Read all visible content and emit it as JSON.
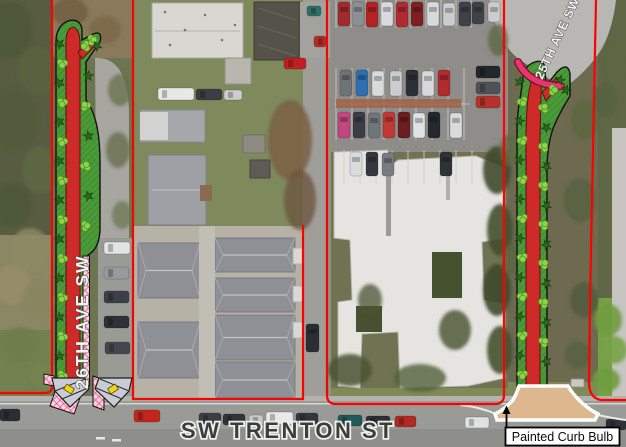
{
  "map": {
    "type": "aerial-improvement-plan",
    "street_labels": {
      "left_avenue": "26TH AVE SW",
      "right_avenue": "25TH AVE SW",
      "bottom_street": "SW TRENTON ST"
    },
    "callout": {
      "label": "Painted Curb Bulb"
    }
  },
  "colors": {
    "painted_lane_red": "#ce2a27",
    "planting_green": "#4a9a38",
    "planting_hatch_green": "#37802b",
    "shrub_dark_green": "#2c681c",
    "bush_light_green": "#8fd348",
    "crosshatch_pink": "#e8417a",
    "crosshatch_pink_bg": "#f7d4e0",
    "curb_paint_magenta": "#e8356e",
    "curb_bulb_tan": "#ddb88e",
    "curb_ramp_gray": "#c9ccd3",
    "tactile_yellow": "#f2d800",
    "property_line_red": "#fe0000",
    "street_label_light": "#f2f2f0",
    "street_label_dark": "#3d3d3d"
  }
}
